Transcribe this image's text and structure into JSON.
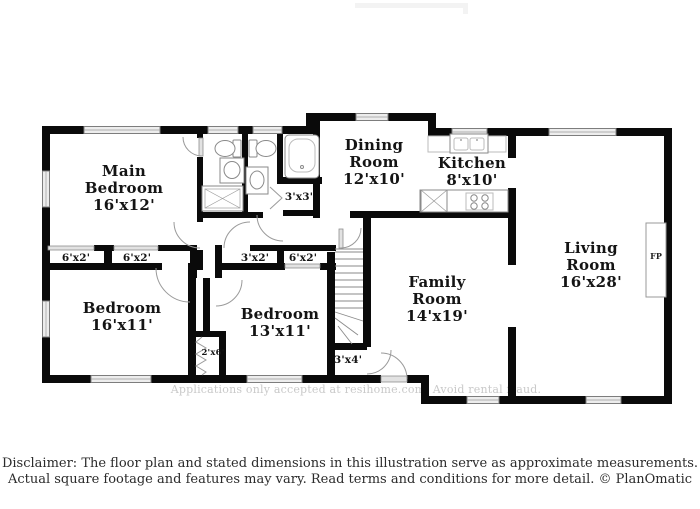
{
  "rooms": {
    "main_bedroom": {
      "line1": "Main",
      "line2": "Bedroom",
      "dims": "16'x12'"
    },
    "dining": {
      "line1": "Dining",
      "line2": "Room",
      "dims": "12'x10'"
    },
    "kitchen": {
      "line1": "Kitchen",
      "dims": "8'x10'"
    },
    "living": {
      "line1": "Living",
      "line2": "Room",
      "dims": "16'x28'"
    },
    "family": {
      "line1": "Family",
      "line2": "Room",
      "dims": "14'x19'"
    },
    "bedroom1": {
      "line1": "Bedroom",
      "dims": "16'x11'"
    },
    "bedroom2": {
      "line1": "Bedroom",
      "dims": "13'x11'"
    }
  },
  "closets": {
    "mb_left": "6'x2'",
    "mb_right": "6'x2'",
    "hall": "3'x2'",
    "bedroom2": "6'x2'",
    "bath": "3'x3'",
    "bedroom1_small": "2'x6'",
    "entry": "3'x4'"
  },
  "fireplace": {
    "label": "FP"
  },
  "watermark": "Applications only accepted at resihome.com. Avoid rental fraud.",
  "disclaimer": {
    "line1": "Disclaimer: The floor plan and stated dimensions in this illustration serve as approximate measurements.",
    "line2": "Actual square footage and features may vary. Read terms and conditions for more detail. © PlanOmatic"
  },
  "colors": {
    "wall": "#0a0a0a",
    "window_fill": "#ededed",
    "door_arc": "#9a9a9a",
    "label_text": "#141414",
    "watermark_text": "#c9c9c9",
    "disclaimer_text": "#2b2b2b",
    "background": "#ffffff"
  }
}
